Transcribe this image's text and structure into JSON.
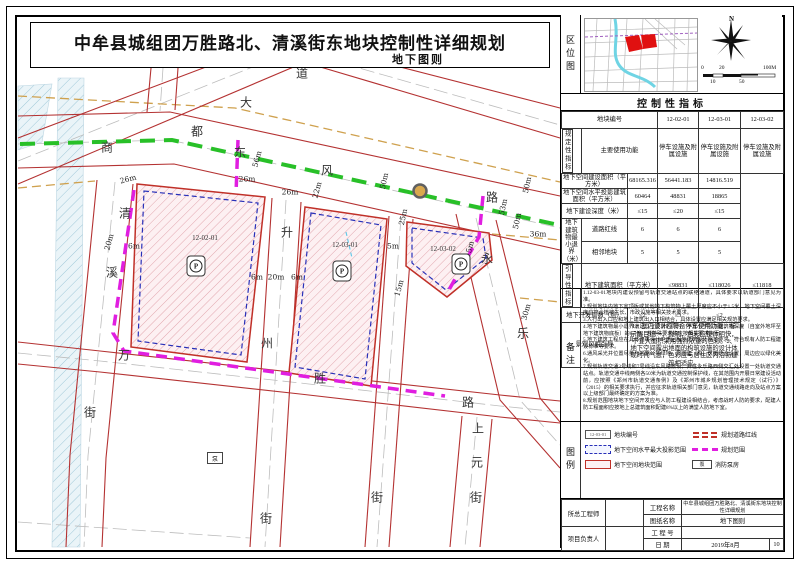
{
  "title": {
    "main": "中牟县城组团万胜路北、清溪街东地块控制性详细规划",
    "sub": "地下图则"
  },
  "colors": {
    "road_edge": "#b43232",
    "metro_line_green": "#28c028",
    "boundary_magenta": "#e01ee0",
    "projection_blue": "#2830b8",
    "plot_fill_pink": "#fdf0f2",
    "yellow_line_tan": "#cfa14e",
    "station_fill": "#d9a94e",
    "river_blue": "#eaf4f8"
  },
  "map": {
    "road_labels": [
      {
        "t": "商",
        "x": 107,
        "y": 147
      },
      {
        "t": "都",
        "x": 197,
        "y": 131
      },
      {
        "t": "大",
        "x": 246,
        "y": 102
      },
      {
        "t": "道",
        "x": 302,
        "y": 73
      },
      {
        "t": "东",
        "x": 240,
        "y": 152
      },
      {
        "t": "风",
        "x": 327,
        "y": 170
      },
      {
        "t": "路",
        "x": 492,
        "y": 197
      },
      {
        "t": "清",
        "x": 125,
        "y": 213
      },
      {
        "t": "溪",
        "x": 112,
        "y": 272
      },
      {
        "t": "街",
        "x": 90,
        "y": 412
      },
      {
        "t": "升",
        "x": 287,
        "y": 232
      },
      {
        "t": "州",
        "x": 267,
        "y": 343
      },
      {
        "t": "街",
        "x": 266,
        "y": 518
      },
      {
        "t": "万",
        "x": 124,
        "y": 355
      },
      {
        "t": "胜",
        "x": 320,
        "y": 378
      },
      {
        "t": "路",
        "x": 468,
        "y": 402
      },
      {
        "t": "永",
        "x": 487,
        "y": 258
      },
      {
        "t": "乐",
        "x": 523,
        "y": 333
      },
      {
        "t": "上",
        "x": 478,
        "y": 428
      },
      {
        "t": "元",
        "x": 477,
        "y": 462
      },
      {
        "t": "街",
        "x": 476,
        "y": 497
      },
      {
        "t": "街",
        "x": 377,
        "y": 497
      }
    ],
    "dim_labels": [
      {
        "t": "26m",
        "x": 128,
        "y": 179,
        "r": -15
      },
      {
        "t": "20m",
        "x": 109,
        "y": 242,
        "r": -75
      },
      {
        "t": "6m",
        "x": 134,
        "y": 246,
        "r": 0
      },
      {
        "t": "56m",
        "x": 257,
        "y": 159,
        "r": -75
      },
      {
        "t": "26m",
        "x": 247,
        "y": 179,
        "r": 0
      },
      {
        "t": "26m",
        "x": 290,
        "y": 192,
        "r": 0
      },
      {
        "t": "22m",
        "x": 317,
        "y": 190,
        "r": -75
      },
      {
        "t": "50m",
        "x": 384,
        "y": 181,
        "r": -78
      },
      {
        "t": "25m",
        "x": 403,
        "y": 217,
        "r": -78
      },
      {
        "t": "53m",
        "x": 503,
        "y": 207,
        "r": -78
      },
      {
        "t": "50m",
        "x": 527,
        "y": 185,
        "r": -78
      },
      {
        "t": "50m",
        "x": 517,
        "y": 221,
        "r": -78
      },
      {
        "t": "36m",
        "x": 538,
        "y": 234,
        "r": 0
      },
      {
        "t": "30m",
        "x": 526,
        "y": 312,
        "r": -75
      },
      {
        "t": "6m",
        "x": 257,
        "y": 277,
        "r": 0
      },
      {
        "t": "20m",
        "x": 276,
        "y": 277,
        "r": 0
      },
      {
        "t": "6m",
        "x": 297,
        "y": 277,
        "r": 0
      },
      {
        "t": "5m",
        "x": 393,
        "y": 246,
        "r": 0
      },
      {
        "t": "15m",
        "x": 399,
        "y": 288,
        "r": -75
      },
      {
        "t": "5m",
        "x": 470,
        "y": 247,
        "r": -75
      }
    ],
    "plots": [
      {
        "id": "12-02-01",
        "x": 205,
        "y": 238,
        "ix": 196,
        "iy": 266
      },
      {
        "id": "12-03-01",
        "x": 345,
        "y": 245,
        "ix": 342,
        "iy": 271
      },
      {
        "id": "12-03-02",
        "x": 443,
        "y": 249,
        "ix": 461,
        "iy": 264
      }
    ],
    "parking_icon_glyph": "P",
    "pump": {
      "glyph": "泵",
      "x": 215,
      "y": 458
    }
  },
  "panel": {
    "location_label": "区位图",
    "north_label": "N",
    "scale_labels_top": [
      "0",
      "20",
      "100M"
    ],
    "scale_labels_bottom": [
      "10",
      "50"
    ],
    "indicators_title": "控制性指标",
    "table": {
      "plot_no_label": "地块编号",
      "plot_ids": [
        "12-02-01",
        "12-03-01",
        "12-03-02"
      ],
      "regulatory_label": "规定性指标",
      "rows": [
        {
          "label": "主要使用功能",
          "values": [
            "停车设施及附属设施",
            "停车设施及附属设施",
            "停车设施及附属设施"
          ]
        },
        {
          "label": "地下空间建设面积（平方米）",
          "values": [
            "68165.316",
            "56441.183",
            "14816.519"
          ]
        },
        {
          "label": "地下空间水平投影建筑面积（平方米）",
          "values": [
            "60464",
            "48831",
            "18865"
          ]
        },
        {
          "label": "地下建设深度（米）",
          "values": [
            "≤15",
            "≤20",
            "≤15"
          ]
        }
      ],
      "setback_label": "地下建筑物最小退界（米）",
      "setback_rows": [
        {
          "label": "道路红线",
          "values": [
            "6",
            "6",
            "6"
          ]
        },
        {
          "label": "相邻地块",
          "values": [
            "5",
            "5",
            "5"
          ]
        }
      ],
      "guiding_label": "引导性指标",
      "guiding_rows": [
        {
          "label": "地下建筑面积（平方米）",
          "values": [
            "≤98831",
            "≤118026",
            "≤11818"
          ]
        },
        {
          "label": "地下开发层数（层）",
          "values": [
            "≤2",
            "≤3",
            "≤2"
          ]
        }
      ],
      "landscape_label": "景观风貌引导",
      "landscape_text": "1、室内设计应符合停车使用功能，标示醒目统一、鲜明，色彩应整体明快，不宜大面积采用强烈浓重的色彩。2、地下空间露出地面的构筑设施的设计体现时代气息，色彩应与居住区内沿街建筑相适应。"
    },
    "notes_label": "备注",
    "notes": [
      "1.12-03-01地块内建设预留与轨道交通站点的联络通道，具体要求以轨道部门意见为准。",
      "2.规划地块内地下室顶板或其他地下构筑物上覆土厚度应不小于1.5米，地下空间覆土深度应符合植被生长、市政设施等相关技术要求。",
      "3.人行出入口应和地上建筑出入口相结合，具体设置应满足相关规范要求。",
      "4.地下建筑物最小退界满足以上要求的同时，不宜小于地下建筑物深度（自室外地坪至地下建筑物底板）的0.7倍，若特殊要求的应按相关要求执行。",
      "5.地下建筑工程应在具体建筑设计中满足相应建筑设计规范要求，符合现有人防工程建设标准等要求。",
      "6.通风采光井位置尽量与地面公共绿地、周围建（构）筑物结合设置，周边应以绿化美化。",
      "7.规划轨道交通3号线和7号线沿东风路敷设，并在永乐路西侧交汇处设置一处轨道交通站点。轨道交通中线两侧各50米为轨道交通控制保护线，在其范围内开展日常建设活动前，应按照《郑州市轨道交通条例》及《郑州市城乡规划管理技术规定（试行）》（2015）的相关要求执行，并应征求轨道相关部门意见，轨道交通线路走向及站点方案以上级部门最终确定的方案为准。",
      "8.规划范围地块地下空间开发应与人防工程建设相结合，考虑战时人防的要求，配建人防工程面积应按地上总建筑面积配建8%以上的满堂人防地下室。"
    ],
    "legend_label": "图例",
    "legend": {
      "left": [
        {
          "sym": "plotno",
          "label": "地块编号",
          "sample": "12-03-01"
        },
        {
          "sym": "bluedash",
          "label": "地下空间水平最大投影范围"
        },
        {
          "sym": "redbox",
          "label": "地下空间地块范围"
        }
      ],
      "right": [
        {
          "sym": "roadline",
          "label": "规划道路红线"
        },
        {
          "sym": "magdash",
          "label": "规划范围"
        },
        {
          "sym": "pump",
          "label": "消防泵房",
          "sample": "泵"
        }
      ]
    },
    "titleblock": {
      "chief_label": "所总工程师",
      "pm_label": "项目负责人",
      "project_label": "工程名称",
      "project_value": "中牟县城组团万胜路北、清溪街东地块控制性详细规划",
      "drawing_label": "图纸名称",
      "drawing_value": "地下图则",
      "number_label": "工 程 号",
      "number_value": "",
      "date_label": "日  期",
      "date_value": "2019年8月",
      "sheet_no": "10"
    }
  }
}
